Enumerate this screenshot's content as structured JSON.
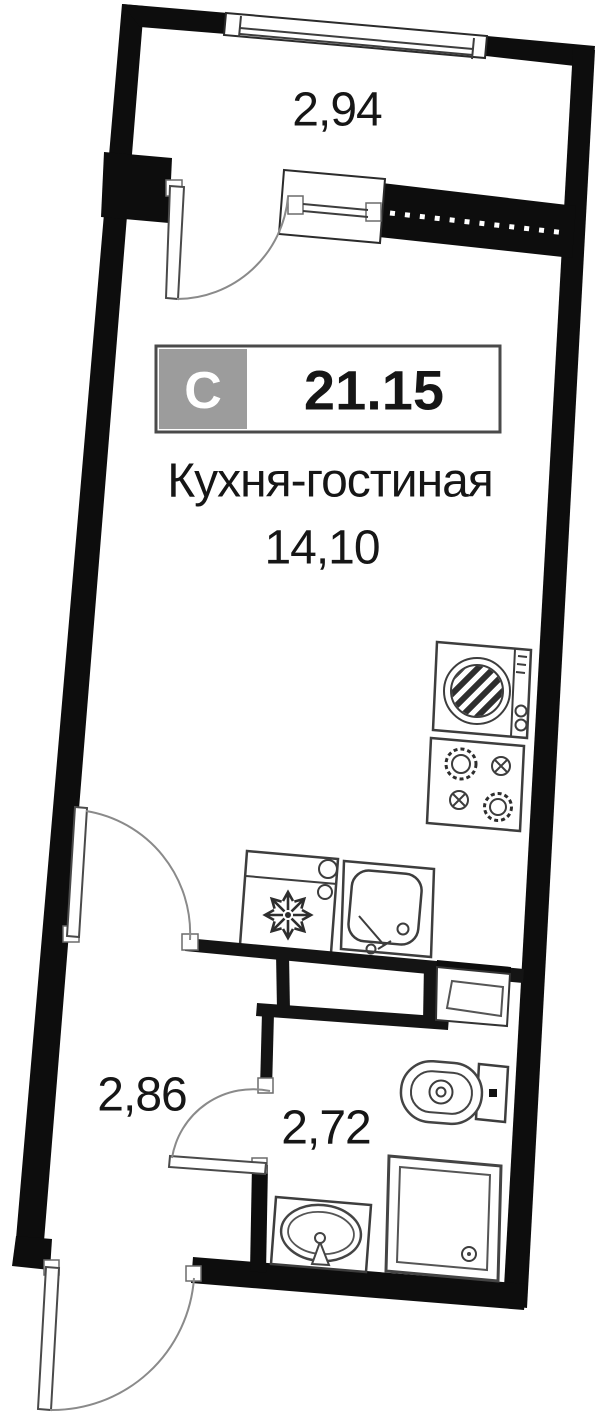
{
  "floor_plan": {
    "unit_badge": {
      "type_letter": "С",
      "total_area": "21.15"
    },
    "rooms": {
      "balcony": {
        "area": "2,94"
      },
      "kitchen_living": {
        "name": "Кухня-гостиная",
        "area": "14,10"
      },
      "hallway": {
        "area": "2,86"
      },
      "bathroom": {
        "area": "2,72"
      }
    },
    "colors": {
      "wall": "#0d0d0d",
      "text": "#161616",
      "badge_gray": "#9c9c9c",
      "badge_border": "#4a4a4a",
      "fixture_line": "#3d3d3d",
      "door_arc": "#8a8a8a"
    },
    "fixtures": [
      "top-window",
      "balcony-door",
      "balcony-window-unit",
      "hatched-wall",
      "washing-machine",
      "stove",
      "fridge",
      "kitchen-sink",
      "vent-shaft",
      "toilet",
      "shower-tray",
      "washbasin",
      "bathroom-door",
      "kitchen-door",
      "entrance-door"
    ]
  }
}
